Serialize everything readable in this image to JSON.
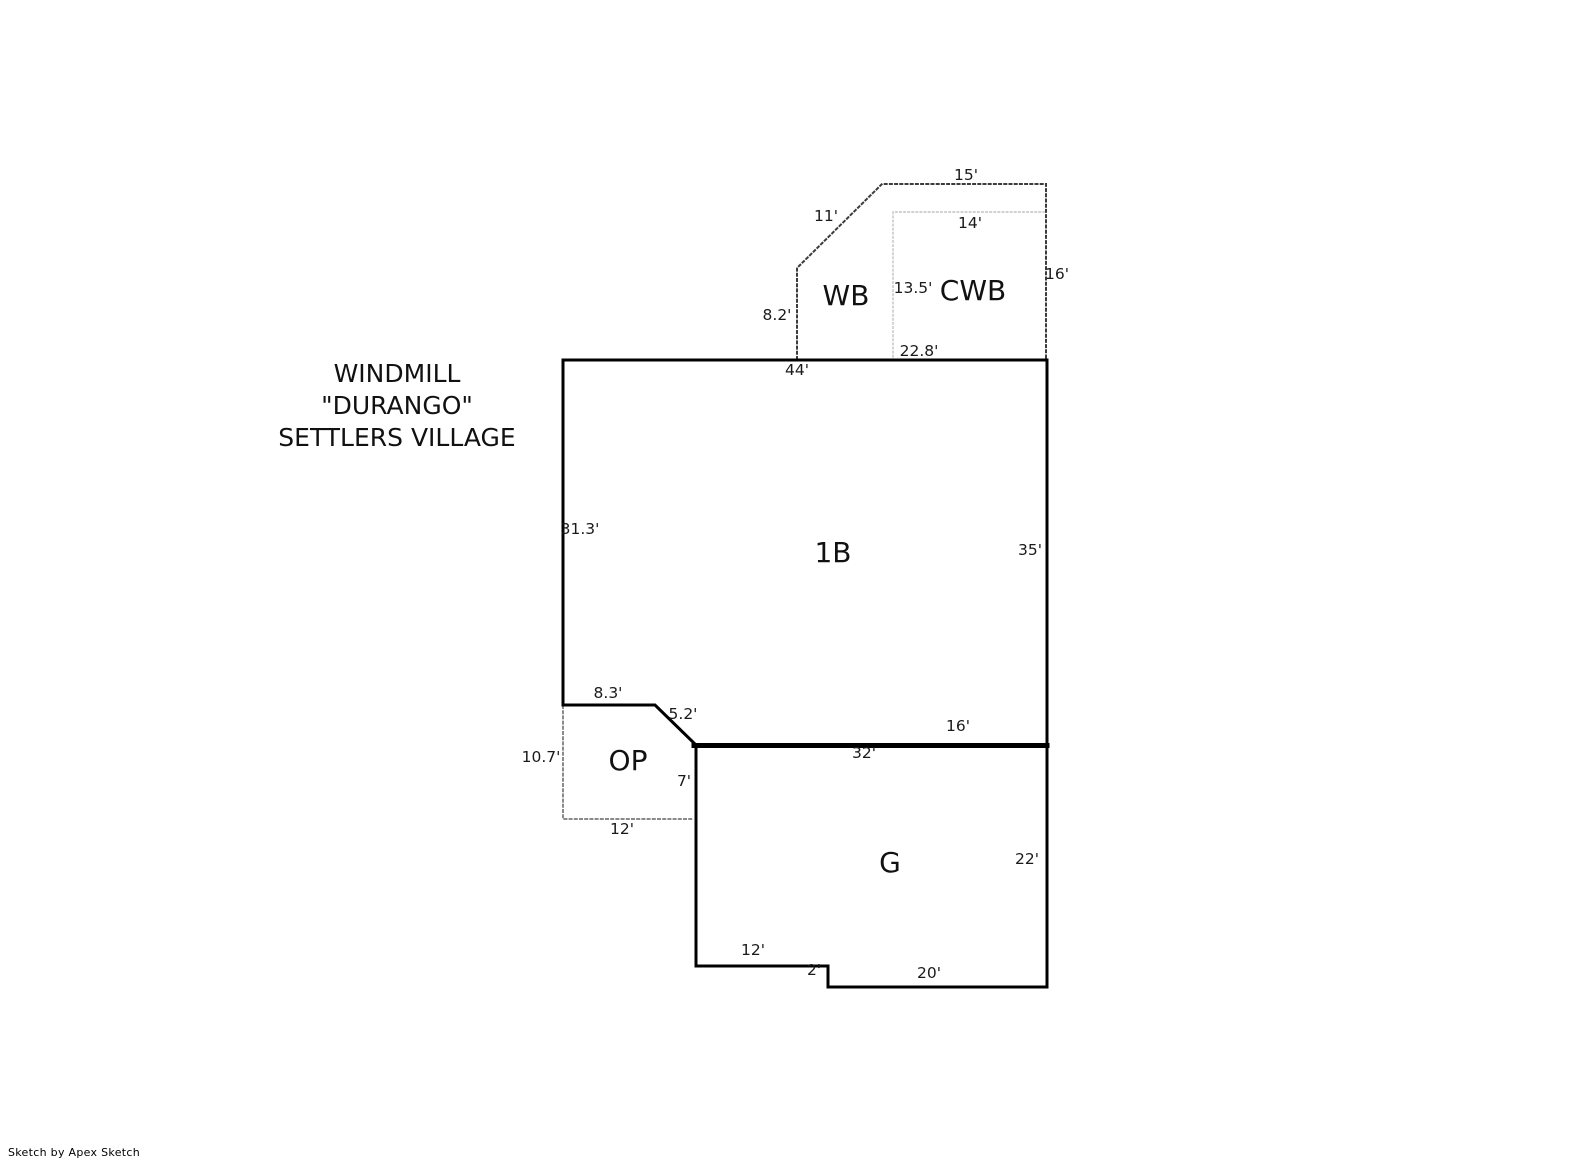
{
  "title": {
    "lines": [
      "WINDMILL",
      "\"DURANGO\"",
      "SETTLERS VILLAGE"
    ]
  },
  "credit": "Sketch by Apex Sketch",
  "colors": {
    "wall": "#000000",
    "thick_wall": "#000000",
    "dotted_dark": "#3c3c3c",
    "dotted_gray": "#8a8a8a",
    "dotted_light": "#c2c2c2",
    "text": "#1a1a1a",
    "background": "#ffffff"
  },
  "rooms": [
    {
      "code": "WB"
    },
    {
      "code": "CWB"
    },
    {
      "code": "1B"
    },
    {
      "code": "OP"
    },
    {
      "code": "G"
    }
  ],
  "dims": [
    {
      "label": "15'"
    },
    {
      "label": "11'"
    },
    {
      "label": "14'"
    },
    {
      "label": "16'"
    },
    {
      "label": "13.5'"
    },
    {
      "label": "8.2'"
    },
    {
      "label": "22.8'"
    },
    {
      "label": "44'"
    },
    {
      "label": "31.3'"
    },
    {
      "label": "35'"
    },
    {
      "label": "8.3'"
    },
    {
      "label": "5.2'"
    },
    {
      "label": "16'"
    },
    {
      "label": "32'"
    },
    {
      "label": "10.7'"
    },
    {
      "label": "7'"
    },
    {
      "label": "12'"
    },
    {
      "label": "22'"
    },
    {
      "label": "12'"
    },
    {
      "label": "2'"
    },
    {
      "label": "20'"
    }
  ]
}
